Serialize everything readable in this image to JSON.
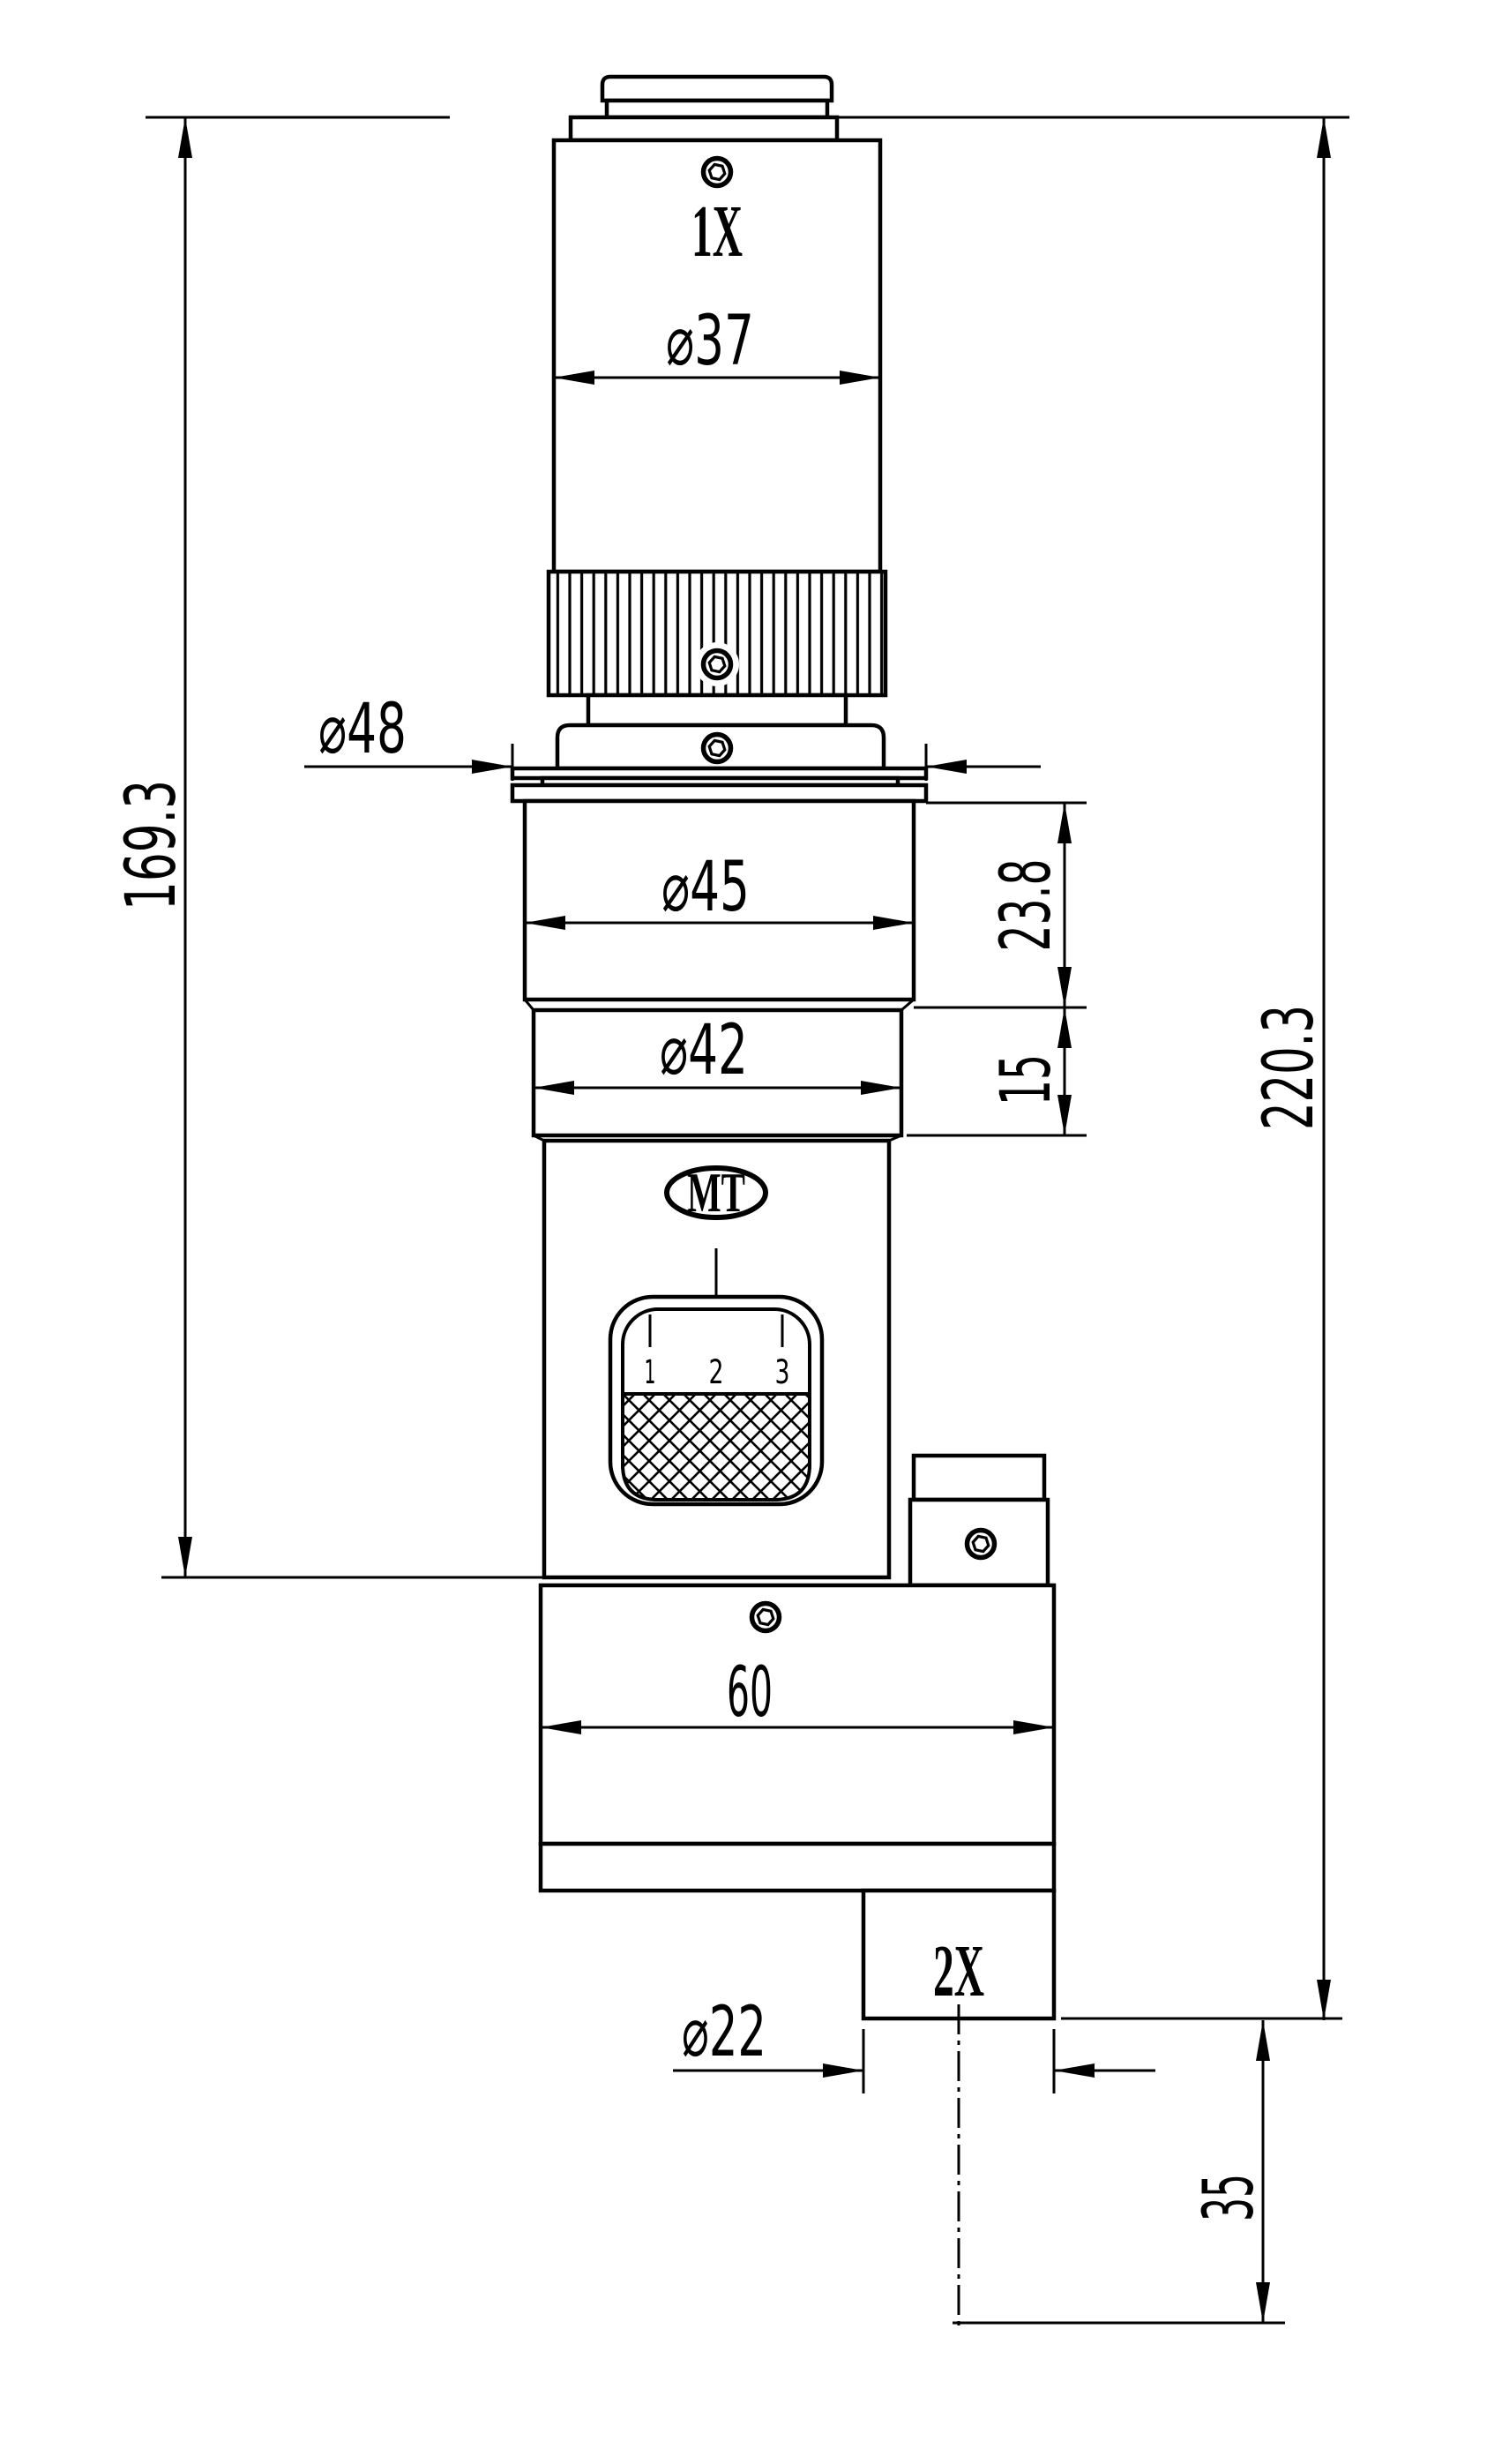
{
  "title": "Microscope zoom adapter technical drawing",
  "colors": {
    "line": "#000000",
    "background": "#ffffff"
  },
  "part_labels": {
    "top_magnification": "1X",
    "bottom_magnification": "2X",
    "logo": "MT"
  },
  "zoom_scale": {
    "tick_1": "1",
    "tick_2": "2",
    "tick_3": "3"
  },
  "dimensions": {
    "dia_top_cylinder": "⌀37",
    "dia_flange": "⌀48",
    "dia_upper_ring": "⌀45",
    "dia_lower_ring": "⌀42",
    "dia_bottom_port": "⌀22",
    "height_left_overall": "169.3",
    "height_right_overall": "220.3",
    "height_upper_ring": "23.8",
    "height_lower_ring": "15",
    "width_base": "60",
    "height_bottom_port": "35"
  }
}
